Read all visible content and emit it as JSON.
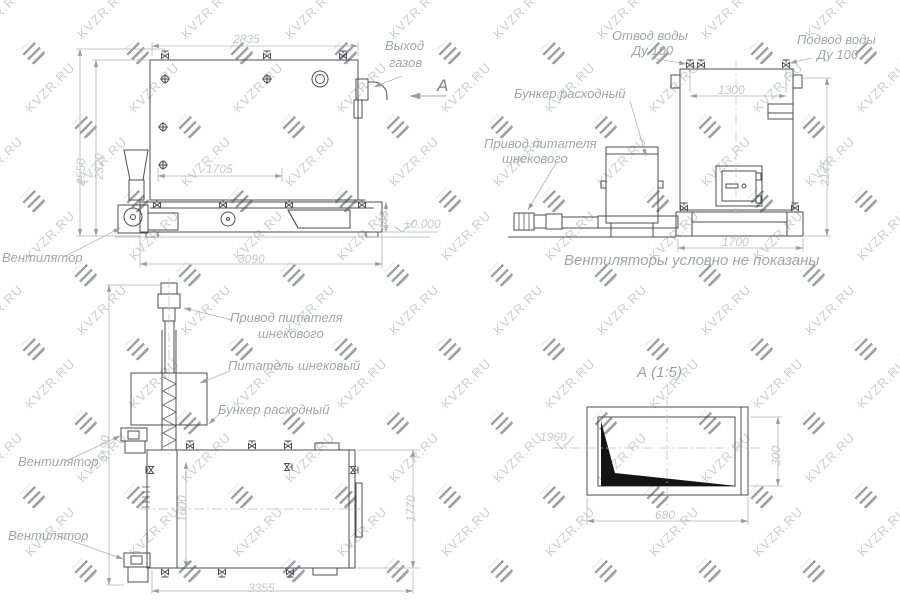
{
  "watermark": {
    "text": "KVZR.RU"
  },
  "views": {
    "side": {
      "labels": {
        "gas_exit_line1": "Выход",
        "gas_exit_line2": "газов",
        "fan": "Вентилятор",
        "view_letter": "А",
        "level_mark": "±0.000"
      },
      "dims": {
        "width_top": "2835",
        "width_inner": "1705",
        "height_outer": "2550",
        "height_inner": "2320",
        "width_bottom": "3090",
        "base_height": "445"
      }
    },
    "front": {
      "labels": {
        "water_out_line1": "Отвод воды",
        "water_out_line2": "Ду 100",
        "water_in_line1": "Подвод воды",
        "water_in_line2": "Ду 100",
        "hopper": "Бункер расходный",
        "drive_line1": "Привод питателя",
        "drive_line2": "шнекового",
        "note": "Вентиляторы условно не показаны"
      },
      "dims": {
        "pipe_span": "1300",
        "height": "2175",
        "base_width": "1700"
      }
    },
    "plan": {
      "labels": {
        "drive_line1": "Привод питателя",
        "drive_line2": "шнекового",
        "feeder": "Питатель шнековый",
        "hopper": "Бункер расходный",
        "fan_top": "Вентилятор",
        "fan_bottom": "Вентилятор"
      },
      "dims": {
        "length_total": "4190",
        "width_inner": "1600",
        "width_right": "1770",
        "length_bottom": "3355"
      }
    },
    "detail": {
      "title": "А  (1:5)",
      "dims": {
        "width": "680",
        "height": "300",
        "level": "1960"
      }
    }
  }
}
